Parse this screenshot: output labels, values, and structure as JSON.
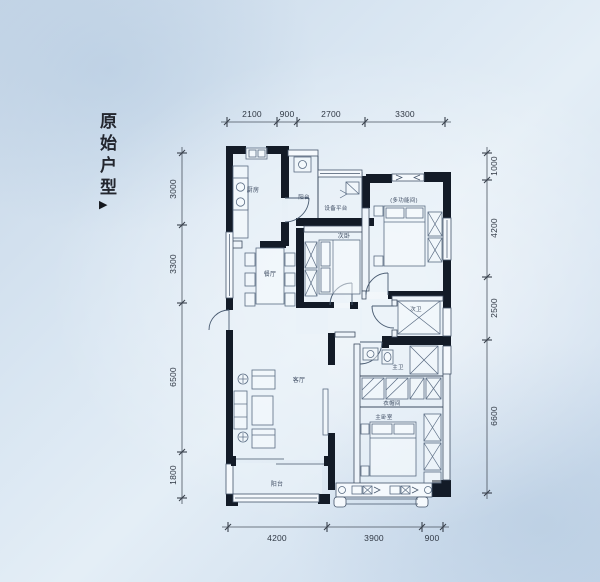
{
  "title": {
    "text": "原始户型",
    "arrow": "▶"
  },
  "dims": {
    "top": [
      "2100",
      "900",
      "2700",
      "3300"
    ],
    "left": [
      "3000",
      "3300",
      "6500",
      "1800"
    ],
    "right": [
      "1000",
      "4200",
      "2500",
      "6600"
    ],
    "bottom": [
      "4200",
      "3900",
      "900"
    ]
  },
  "rooms": {
    "kitchen": "厨房",
    "service_balcony": "阳台",
    "equipment_platform": "设备平台",
    "north_bedroom_note": "(多功能间)",
    "second_bedroom": "次卧",
    "dining": "餐厅",
    "living": "客厅",
    "guest_bath": "次卫",
    "master_bath": "主卫",
    "cloakroom": "衣帽间",
    "master_bedroom": "主卧室",
    "balcony": "阳台"
  },
  "colors": {
    "background": "#cfdeee",
    "wall": "#131b27",
    "line": "#3e4d61"
  }
}
